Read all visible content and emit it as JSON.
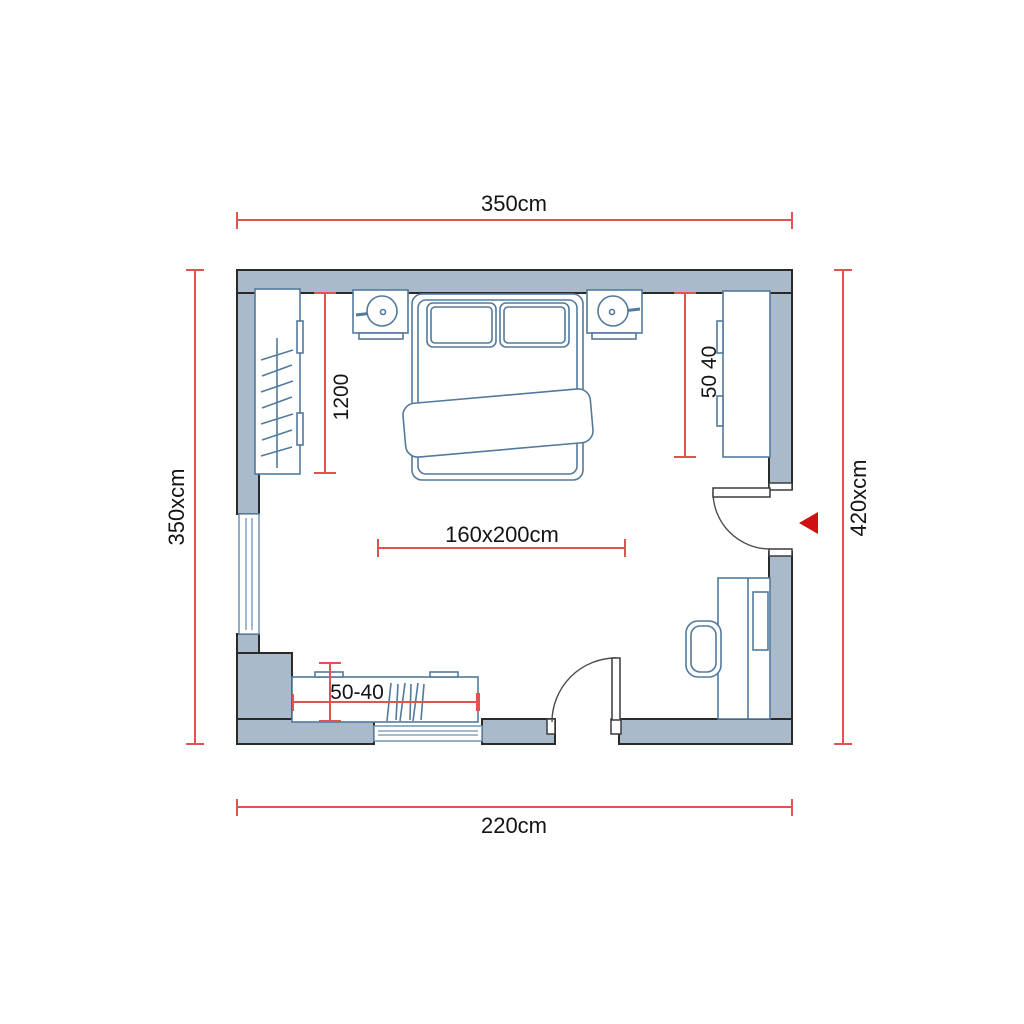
{
  "page": {
    "type": "bedroom-floor-plan",
    "background": "#ffffff"
  },
  "colors": {
    "wall_fill": "#a9bbca",
    "wall_outline": "#2a2a2a",
    "furniture_outline": "#527a9d",
    "window_outline": "#6f94b5",
    "dimension_red": "#e2524e",
    "entrance_arrow_red": "#cf1113",
    "label_text": "#141414"
  },
  "dimensions": {
    "top_width": "350cm",
    "bottom_width": "220cm",
    "left_height": "350xcm",
    "right_height": "420xcm",
    "bed_size": "160x200cm",
    "left_wardrobe_length": "1200",
    "right_cabinet_depth": "50 40",
    "bottom_dresser_depth": "50-40"
  },
  "furniture": {
    "items": [
      "double-bed",
      "pillow-left",
      "pillow-right",
      "blanket",
      "nightstand-left",
      "lamp-left",
      "nightstand-right",
      "lamp-right",
      "wardrobe-left",
      "cabinet-right",
      "desk",
      "office-chair",
      "dresser-bottom",
      "window-left",
      "window-bottom",
      "door-right",
      "door-bottom",
      "entrance-arrow"
    ]
  }
}
